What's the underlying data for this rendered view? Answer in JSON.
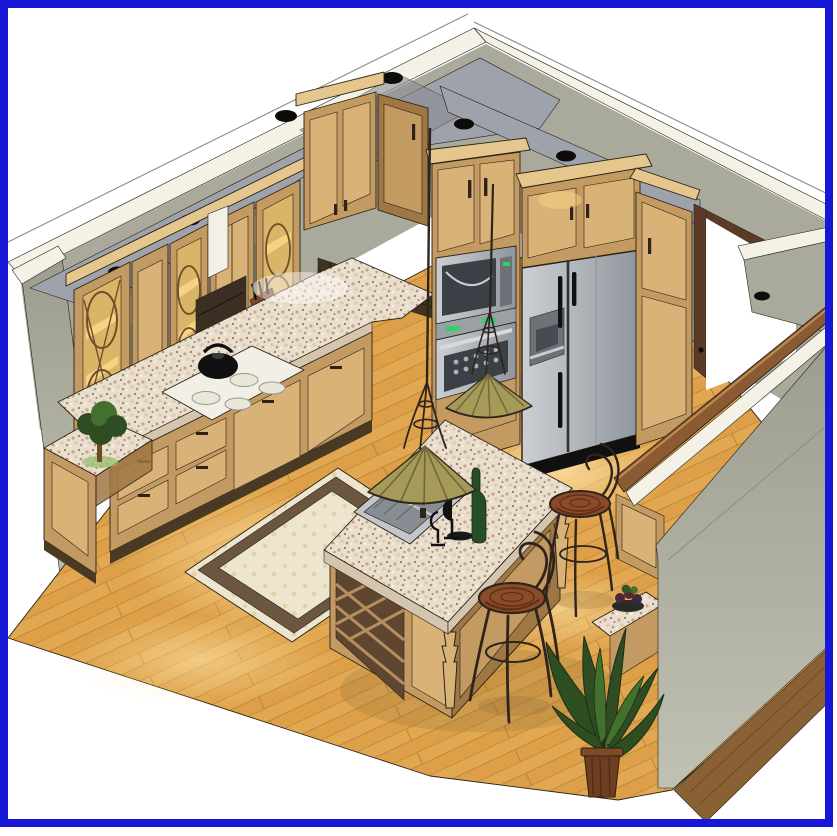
{
  "image": {
    "kind": "3D architectural rendering (CAD cutaway perspective)",
    "subject": "Kitchen interior design visualization",
    "frame": "solid blue border around white page",
    "text_content": "none visible"
  },
  "palette": {
    "border_blue": "#1717D8",
    "bg": "#FFFFFF",
    "ink": "#2A2115",
    "wall": "#A9AA9B",
    "wall_light": "#C4C5B6",
    "wall_dark": "#8E8F80",
    "cap": "#F4F2E7",
    "soffit": "#9EA2AA",
    "soffit_dark": "#878B93",
    "dot": "#0E0C0A",
    "wood": "#C49A63",
    "wood_light": "#D8B277",
    "wood_dark": "#9F7743",
    "wood_deep": "#6E4E2B",
    "crown": "#E5C68C",
    "glow": "#F6D382",
    "glass_bg": "#D9B568",
    "granite_edge": "#D3C5AE",
    "granite_base": "#E9DFCC",
    "steel": "#B9BEC3",
    "steel_dark": "#82888E",
    "appliance_black": "#101010",
    "cook_white": "#F2F0E6",
    "floor": "#E2A851",
    "floor_plank": "#D8993F",
    "floor_line": "#B57F33",
    "floor_glow": "#FFE7AC",
    "floor_outer": "#8A6134",
    "rug_field": "#EDE5CD",
    "rug_border": "#6B5642",
    "rug_motif": "#DFD3AE",
    "shade_olive": "#A59A58",
    "shade_dark": "#6F673A",
    "iron": "#2E241C",
    "wicker": "#8B4A28",
    "wicker_dark": "#5E2F16",
    "plant": "#2F4D22",
    "plant_light": "#44702F",
    "pot": "#6E3E20",
    "door_brown": "#5C3A28",
    "wine_green": "#254D28"
  },
  "scene": {
    "objects": [
      "blue page frame",
      "cutaway walls with white cut caps",
      "gray soffit with black recessed light cans",
      "glass-front lattice display cabinets (lit)",
      "raised-panel upper cabinets with crown molding",
      "angled corner wall cabinet",
      "spice rail with jars",
      "knife block",
      "granite L-shaped countertop",
      "white four-burner cooktop with black kettle",
      "angled end base cabinet with topiary plant",
      "built-in microwave and wall oven column",
      "stainless side-by-side refrigerator with dispenser",
      "pantry cabinet beside doorway",
      "open doorway with dark wood frame",
      "kitchen island with sink, faucet, wine bottle and glasses",
      "island wine-lattice end panel and turned legs",
      "two tiffany-style olive pendant lights",
      "two wrought-iron bar stools with wicker seats",
      "cream area rug with dark border",
      "diagonal hardwood plank floor with light pools",
      "half wall (pony wall) with wood cap rail",
      "writing desk with fruit bowl",
      "tall potted plant in wood planter"
    ]
  }
}
